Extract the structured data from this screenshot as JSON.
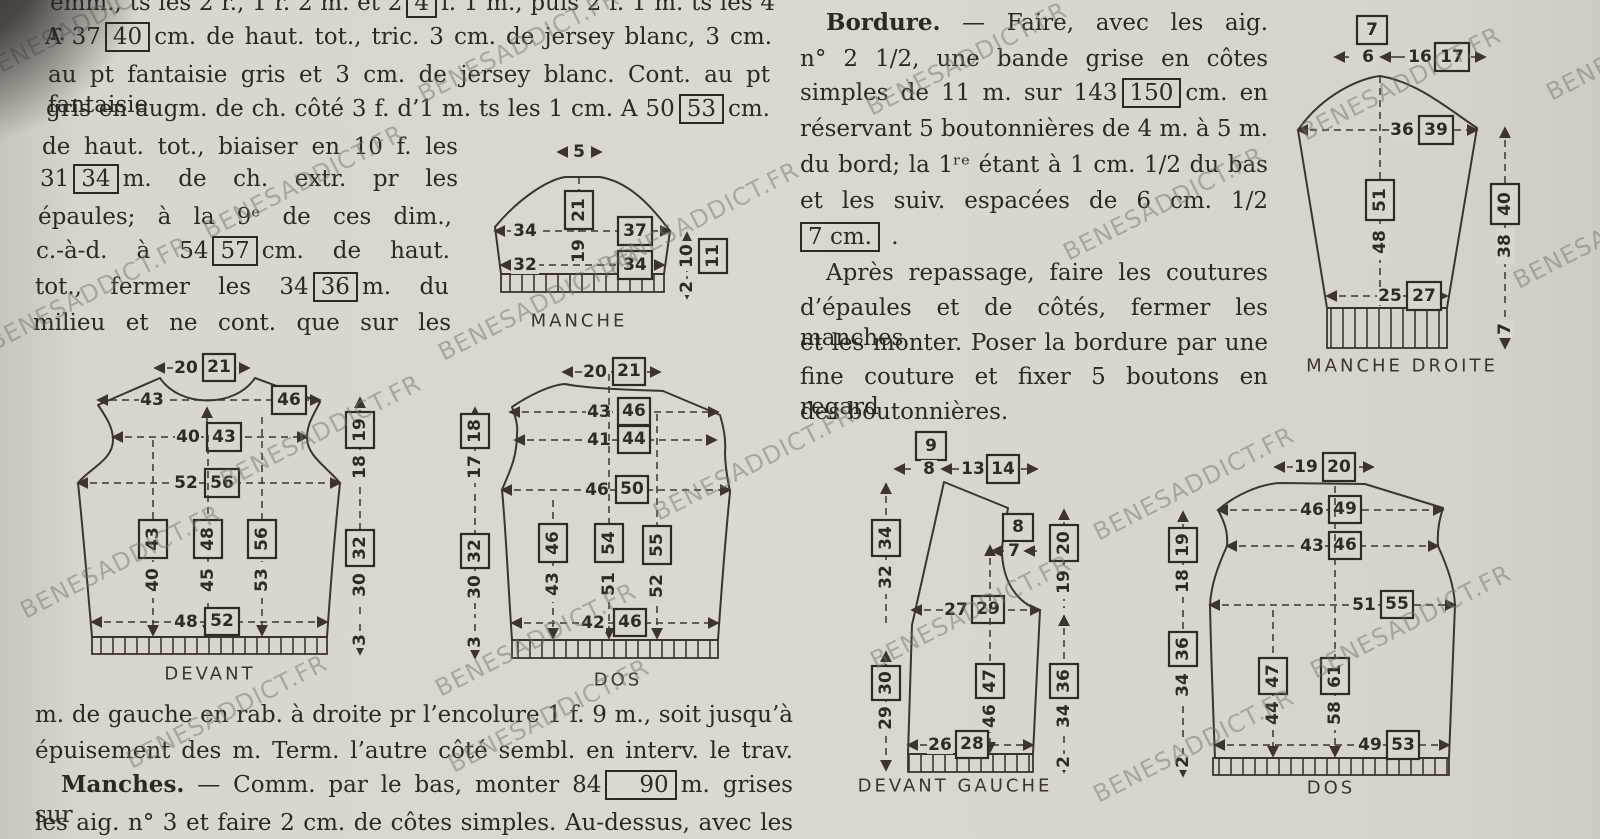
{
  "watermark": "BENESADDICT.FR",
  "col1": {
    "l1a": "emm., ts les 2 r., 1 r. 2 m. et 2",
    "l1box": "4",
    "l1b": "f. 1 m., puis 2 f. 1 m. ts les 4 r.",
    "l2a": "A 37",
    "l2box": "40",
    "l2b": "cm. de haut. tot., tric. 3 cm. de jersey blanc, 3 cm.",
    "l3": "au pt fantaisie gris et 3 cm. de jersey blanc. Cont. au pt fantaisie",
    "l4a": "gris en augm. de ch. côté 3 f. d’1 m. ts les 1 cm. A 50",
    "l4box": "53",
    "l4b": "cm.",
    "l5": "de haut. tot., biaiser en 10 f. les",
    "l6a": "31",
    "l6box": "34",
    "l6b": "m. de ch. extr. pr les",
    "l7": "épaules; à la 9ᵉ de ces dim.,",
    "l8a": "c.-à-d. à 54",
    "l8box": "57",
    "l8b": "cm. de haut.",
    "l9a": "tot., fermer les 34",
    "l9box": "36",
    "l9b": "m. du",
    "l10": "milieu et ne cont. que sur les"
  },
  "bordure": {
    "head": "Bordure.",
    "l1": "— Faire, avec les aig.",
    "l2": "n° 2 1/2, une bande grise en côtes",
    "l3a": "simples de 11 m. sur 143",
    "l3box": "150",
    "l3b": "cm. en",
    "l4": "réservant 5 boutonnières de 4 m. à 5 m.",
    "l5": "du bord; la 1ʳᵉ étant à 1 cm. 1/2 du bas",
    "l6": "et les suiv. espacées de 6 cm. 1/2",
    "l7box": "7 cm.",
    "l7b": ".",
    "l8": "Après repassage, faire les coutures",
    "l9": "d’épaules et de côtés, fermer les manches",
    "l10": "et les monter. Poser la bordure par une",
    "l11": "fine couture et fixer 5 boutons en regard",
    "l12": "des boutonnières."
  },
  "bottom": {
    "l1": "m. de gauche en rab. à droite pr l’encolure 1 f. 9 m., soit jusqu’à",
    "l2": "épuisement des m. Term. l’autre côté sembl. en interv. le trav.",
    "l3head": "Manches.",
    "l3a": "— Comm. par le bas, monter 84",
    "l3box": "90",
    "l3b": "m. grises sur",
    "l4": "les aig. n° 3 et faire 2 cm. de côtes simples. Au-dessus, avec les"
  },
  "manche": {
    "label": "MANCHE",
    "top": "5",
    "h_plain": "19",
    "h_box": "21",
    "w1_plain": "34",
    "w1_box": "37",
    "w2_plain": "32",
    "w2_box": "34",
    "side_plain": "10",
    "side_box": "11",
    "side_rib": "2"
  },
  "manche_droite": {
    "label": "MANCHE DROITE",
    "cap_box": "7",
    "cap_a": "6",
    "cap_plain": "16",
    "cap_box2": "17",
    "w_plain": "36",
    "w_box": "39",
    "h_plain": "48",
    "h_box": "51",
    "side_plain": "38",
    "side_box": "40",
    "w2_plain": "25",
    "w2_box": "27",
    "rib_h": "7"
  },
  "devant": {
    "label": "DEVANT",
    "neck_plain": "20",
    "neck_box": "21",
    "shoulder_plain": "43",
    "shoulder_box": "46",
    "upper_plain": "40",
    "upper_box": "43",
    "chest_plain": "52",
    "chest_box": "56",
    "arm_plain": "18",
    "arm_box": "19",
    "len1_plain": "40",
    "len1_box": "43",
    "len2_plain": "45",
    "len2_box": "48",
    "len3_plain": "53",
    "len3_box": "56",
    "hip_plain": "48",
    "hip_box": "52",
    "side_plain": "30",
    "side_box": "32",
    "rib": "3"
  },
  "dos": {
    "label": "DOS",
    "neck_plain": "20",
    "neck_box": "21",
    "shoulder_plain": "43",
    "shoulder_box": "46",
    "upper_plain": "41",
    "upper_box": "44",
    "chest_plain": "46",
    "chest_box": "50",
    "arm_plain": "17",
    "arm_box": "18",
    "len1_plain": "43",
    "len1_box": "46",
    "len2_plain": "51",
    "len2_box": "54",
    "len3_plain": "52",
    "len3_box": "55",
    "hip_plain": "42",
    "hip_box": "46",
    "side_plain": "30",
    "side_box": "32",
    "rib": "3"
  },
  "devant_gauche": {
    "label": "DEVANT GAUCHE",
    "top_box": "9",
    "top_a": "8",
    "top_plain": "13",
    "top_box2": "14",
    "left_plain": "32",
    "left_box": "34",
    "neck_plain": "7",
    "neck_box": "8",
    "arm_plain": "19",
    "arm_box": "20",
    "waist_plain": "27",
    "waist_box": "29",
    "left2_plain": "29",
    "left2_box": "30",
    "mid_plain": "46",
    "mid_box": "47",
    "right_plain": "34",
    "right_box": "36",
    "hip_plain": "26",
    "hip_box": "28",
    "rib": "2"
  },
  "dos2": {
    "label": "DOS",
    "neck_plain": "19",
    "neck_box": "20",
    "shoulder_plain": "46",
    "shoulder_box": "49",
    "upper_plain": "43",
    "upper_box": "46",
    "chest_plain": "51",
    "chest_box": "55",
    "arm_plain": "18",
    "arm_box": "19",
    "len1_plain": "44",
    "len1_box": "47",
    "len2_plain": "58",
    "len2_box": "61",
    "hip_plain": "49",
    "hip_box": "53",
    "side_plain": "34",
    "side_box": "36",
    "rib": "2"
  }
}
